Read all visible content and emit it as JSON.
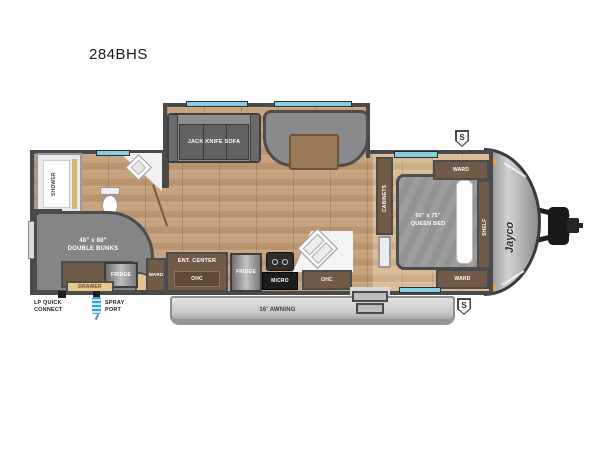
{
  "title": "284BHS",
  "brand": {
    "logo": "Jayco"
  },
  "exterior": {
    "awning_label": "16' AWNING",
    "lp_quick_connect_label": "LP QUICK CONNECT",
    "spray_port_label": "SPRAY PORT",
    "stabilizer_badge": "S"
  },
  "rooms": {
    "bathroom": {
      "shower_label": "SHOWER"
    },
    "bunk_area": {
      "bunks_size": "48\" x 80\"",
      "bunks_name": "DOUBLE BUNKS",
      "fridge_label": "FRIDGE",
      "drawer_label": "DRAWER"
    },
    "living": {
      "sofa_label": "JACK KNIFE SOFA",
      "ward_label": "WARD",
      "ent_center_label": "ENT. CENTER",
      "ohc_label": "OHC"
    },
    "kitchen": {
      "fridge_label": "FRIDGE",
      "micro_label": "MICRO",
      "ohc_label": "OHC"
    },
    "bedroom": {
      "cabinets_label": "CABINETS",
      "bed_size": "60\" x 75\"",
      "bed_name": "QUEEN BED",
      "ward_top_label": "WARD",
      "ward_bottom_label": "WARD",
      "shelf_label": "SHELF"
    }
  },
  "colors": {
    "wall": "#4a4a4a",
    "floor_wood": "#c8a37f",
    "floor_bedroom": "#d9bd99",
    "furniture_gray": "#858585",
    "cabinet_brown": "#6f5b48",
    "drawer_tan": "#e6c88f",
    "window_teal": "#86cfe3",
    "marker_orange": "#f0a030",
    "spray_blue": "#3aa0d8"
  }
}
